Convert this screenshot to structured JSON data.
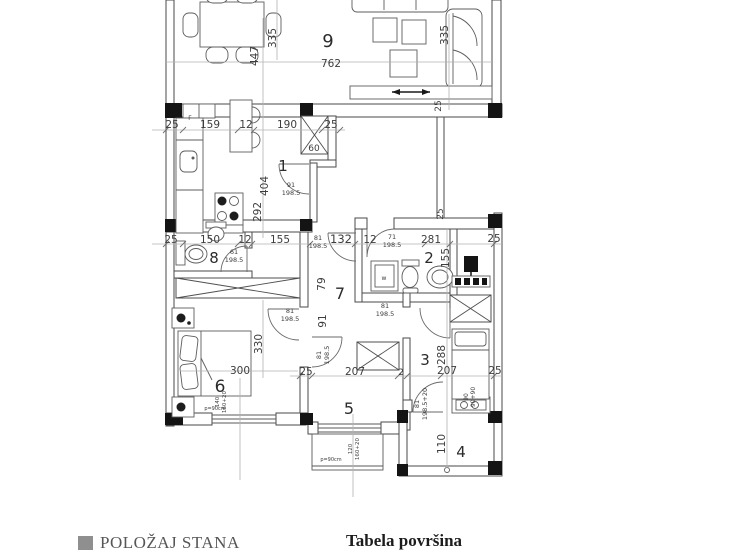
{
  "footer": {
    "legend_label": "POLOŽAJ STANA",
    "table_title": "Tabela površina"
  },
  "colors": {
    "wall_line": "#4a4a4a",
    "dimension_line": "#b3b3b3",
    "text": "#3d3d3d",
    "column_block": "#141414",
    "legend_square": "#8f8f8f"
  },
  "room_numbers": [
    {
      "t": "9",
      "x": 328,
      "y": 47,
      "s": 18
    },
    {
      "t": "1",
      "x": 283,
      "y": 171,
      "s": 15
    },
    {
      "t": "8",
      "x": 214,
      "y": 263,
      "s": 15
    },
    {
      "t": "2",
      "x": 429,
      "y": 263,
      "s": 15
    },
    {
      "t": "7",
      "x": 340,
      "y": 299,
      "s": 16
    },
    {
      "t": "6",
      "x": 220,
      "y": 392,
      "s": 17
    },
    {
      "t": "5",
      "x": 349,
      "y": 414,
      "s": 16
    },
    {
      "t": "3",
      "x": 425,
      "y": 365,
      "s": 15
    },
    {
      "t": "4",
      "x": 461,
      "y": 457,
      "s": 15
    }
  ],
  "dimension_labels": [
    {
      "t": "762",
      "x": 331,
      "y": 67
    },
    {
      "t": "25",
      "x": 172,
      "y": 128
    },
    {
      "t": "159",
      "x": 210,
      "y": 128
    },
    {
      "t": "12",
      "x": 246,
      "y": 128
    },
    {
      "t": "190",
      "x": 287,
      "y": 128
    },
    {
      "t": "25",
      "x": 331,
      "y": 128
    },
    {
      "t": "60",
      "x": 314,
      "y": 151,
      "s": 9
    },
    {
      "t": "25",
      "x": 171,
      "y": 243
    },
    {
      "t": "150",
      "x": 210,
      "y": 243
    },
    {
      "t": "12",
      "x": 245,
      "y": 243
    },
    {
      "t": "155",
      "x": 280,
      "y": 243
    },
    {
      "t": "132",
      "x": 341,
      "y": 243,
      "s": 11.5
    },
    {
      "t": "12",
      "x": 370,
      "y": 243
    },
    {
      "t": "281",
      "x": 431,
      "y": 243
    },
    {
      "t": "25",
      "x": 494,
      "y": 242
    },
    {
      "t": "300",
      "x": 240,
      "y": 374
    },
    {
      "t": "207",
      "x": 355,
      "y": 375
    },
    {
      "t": "25",
      "x": 306,
      "y": 375
    },
    {
      "t": "2",
      "x": 401,
      "y": 375,
      "s": 9
    },
    {
      "t": "207",
      "x": 447,
      "y": 374
    },
    {
      "t": "25",
      "x": 495,
      "y": 374
    },
    {
      "t": "335",
      "x": 276,
      "y": 38,
      "r": -90
    },
    {
      "t": "447",
      "x": 258,
      "y": 56,
      "r": -90
    },
    {
      "t": "335",
      "x": 448,
      "y": 35,
      "r": -90
    },
    {
      "t": "25",
      "x": 441,
      "y": 106,
      "r": -90,
      "s": 9
    },
    {
      "t": "404",
      "x": 268,
      "y": 186,
      "r": -90
    },
    {
      "t": "292",
      "x": 261,
      "y": 212,
      "r": -90
    },
    {
      "t": "25",
      "x": 443,
      "y": 214,
      "r": -90,
      "s": 9
    },
    {
      "t": "155",
      "x": 449,
      "y": 258,
      "r": -90
    },
    {
      "t": "79",
      "x": 325,
      "y": 284,
      "r": -90
    },
    {
      "t": "91",
      "x": 326,
      "y": 321,
      "r": -90
    },
    {
      "t": "330",
      "x": 262,
      "y": 344,
      "r": -90
    },
    {
      "t": "288",
      "x": 445,
      "y": 355,
      "r": -90
    },
    {
      "t": "110",
      "x": 445,
      "y": 444,
      "r": -90
    },
    {
      "t": "91",
      "x": 291,
      "y": 187,
      "s": 6.5
    },
    {
      "t": "198.5",
      "x": 291,
      "y": 195,
      "s": 6.5
    },
    {
      "t": "61",
      "x": 234,
      "y": 254,
      "s": 6.5
    },
    {
      "t": "198.5",
      "x": 234,
      "y": 262,
      "s": 6.5
    },
    {
      "t": "81",
      "x": 318,
      "y": 240,
      "s": 6.5
    },
    {
      "t": "198.5",
      "x": 318,
      "y": 248,
      "s": 6.5
    },
    {
      "t": "71",
      "x": 392,
      "y": 239,
      "s": 6.5
    },
    {
      "t": "198.5",
      "x": 392,
      "y": 247,
      "s": 6.5
    },
    {
      "t": "81",
      "x": 385,
      "y": 308,
      "s": 6.5
    },
    {
      "t": "198.5",
      "x": 385,
      "y": 316,
      "s": 6.5
    },
    {
      "t": "81",
      "x": 290,
      "y": 313,
      "s": 6.5
    },
    {
      "t": "198.5",
      "x": 290,
      "y": 321,
      "s": 6.5
    },
    {
      "t": "81",
      "x": 321,
      "y": 355,
      "r": -90,
      "s": 6.5
    },
    {
      "t": "198.5",
      "x": 329,
      "y": 355,
      "r": -90,
      "s": 6.5
    },
    {
      "t": "81",
      "x": 419,
      "y": 404,
      "r": -90,
      "s": 6.5
    },
    {
      "t": "198.5+20",
      "x": 427,
      "y": 404,
      "r": -90,
      "s": 6.5
    },
    {
      "t": "90",
      "x": 468,
      "y": 397,
      "r": -90,
      "s": 6
    },
    {
      "t": "90+90",
      "x": 475,
      "y": 397,
      "r": -90,
      "s": 6
    },
    {
      "t": "F",
      "x": 190,
      "y": 120,
      "s": 6
    },
    {
      "t": "w",
      "x": 384,
      "y": 280,
      "s": 6
    },
    {
      "t": "p=90cm",
      "x": 215,
      "y": 410,
      "s": 5
    },
    {
      "t": "140",
      "x": 219,
      "y": 402,
      "r": -90,
      "s": 5.5
    },
    {
      "t": "160+20",
      "x": 226,
      "y": 402,
      "r": -90,
      "s": 5.5
    },
    {
      "t": "p=90cm",
      "x": 331,
      "y": 461,
      "s": 5
    },
    {
      "t": "120",
      "x": 352,
      "y": 449,
      "r": -90,
      "s": 5.5
    },
    {
      "t": "160+20",
      "x": 359,
      "y": 449,
      "r": -90,
      "s": 5.5
    }
  ]
}
